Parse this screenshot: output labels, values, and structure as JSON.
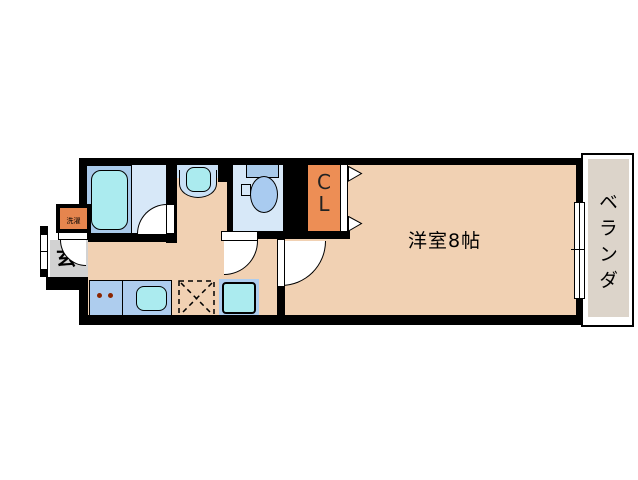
{
  "plan": {
    "main_room_label": "洋室8帖",
    "balcony_label": "ベランダ",
    "closet_line1": "C",
    "closet_line2": "L",
    "entrance_label": "玄",
    "laundry_label": "洗濯"
  },
  "colors": {
    "floor_peach": "#F1D1B3",
    "wet_room_blue": "#D7E8F8",
    "fixture_frame_blue": "#A9CAEA",
    "counter_blue": "#AECDEE",
    "fixture_cyan": "#ABEBEF",
    "closet_orange": "#ED8E55",
    "laundry_orange": "#E5854E",
    "entrance_gray": "#D2D2D2",
    "balcony_gray": "#DCD4CA",
    "wall_black": "#000000"
  }
}
